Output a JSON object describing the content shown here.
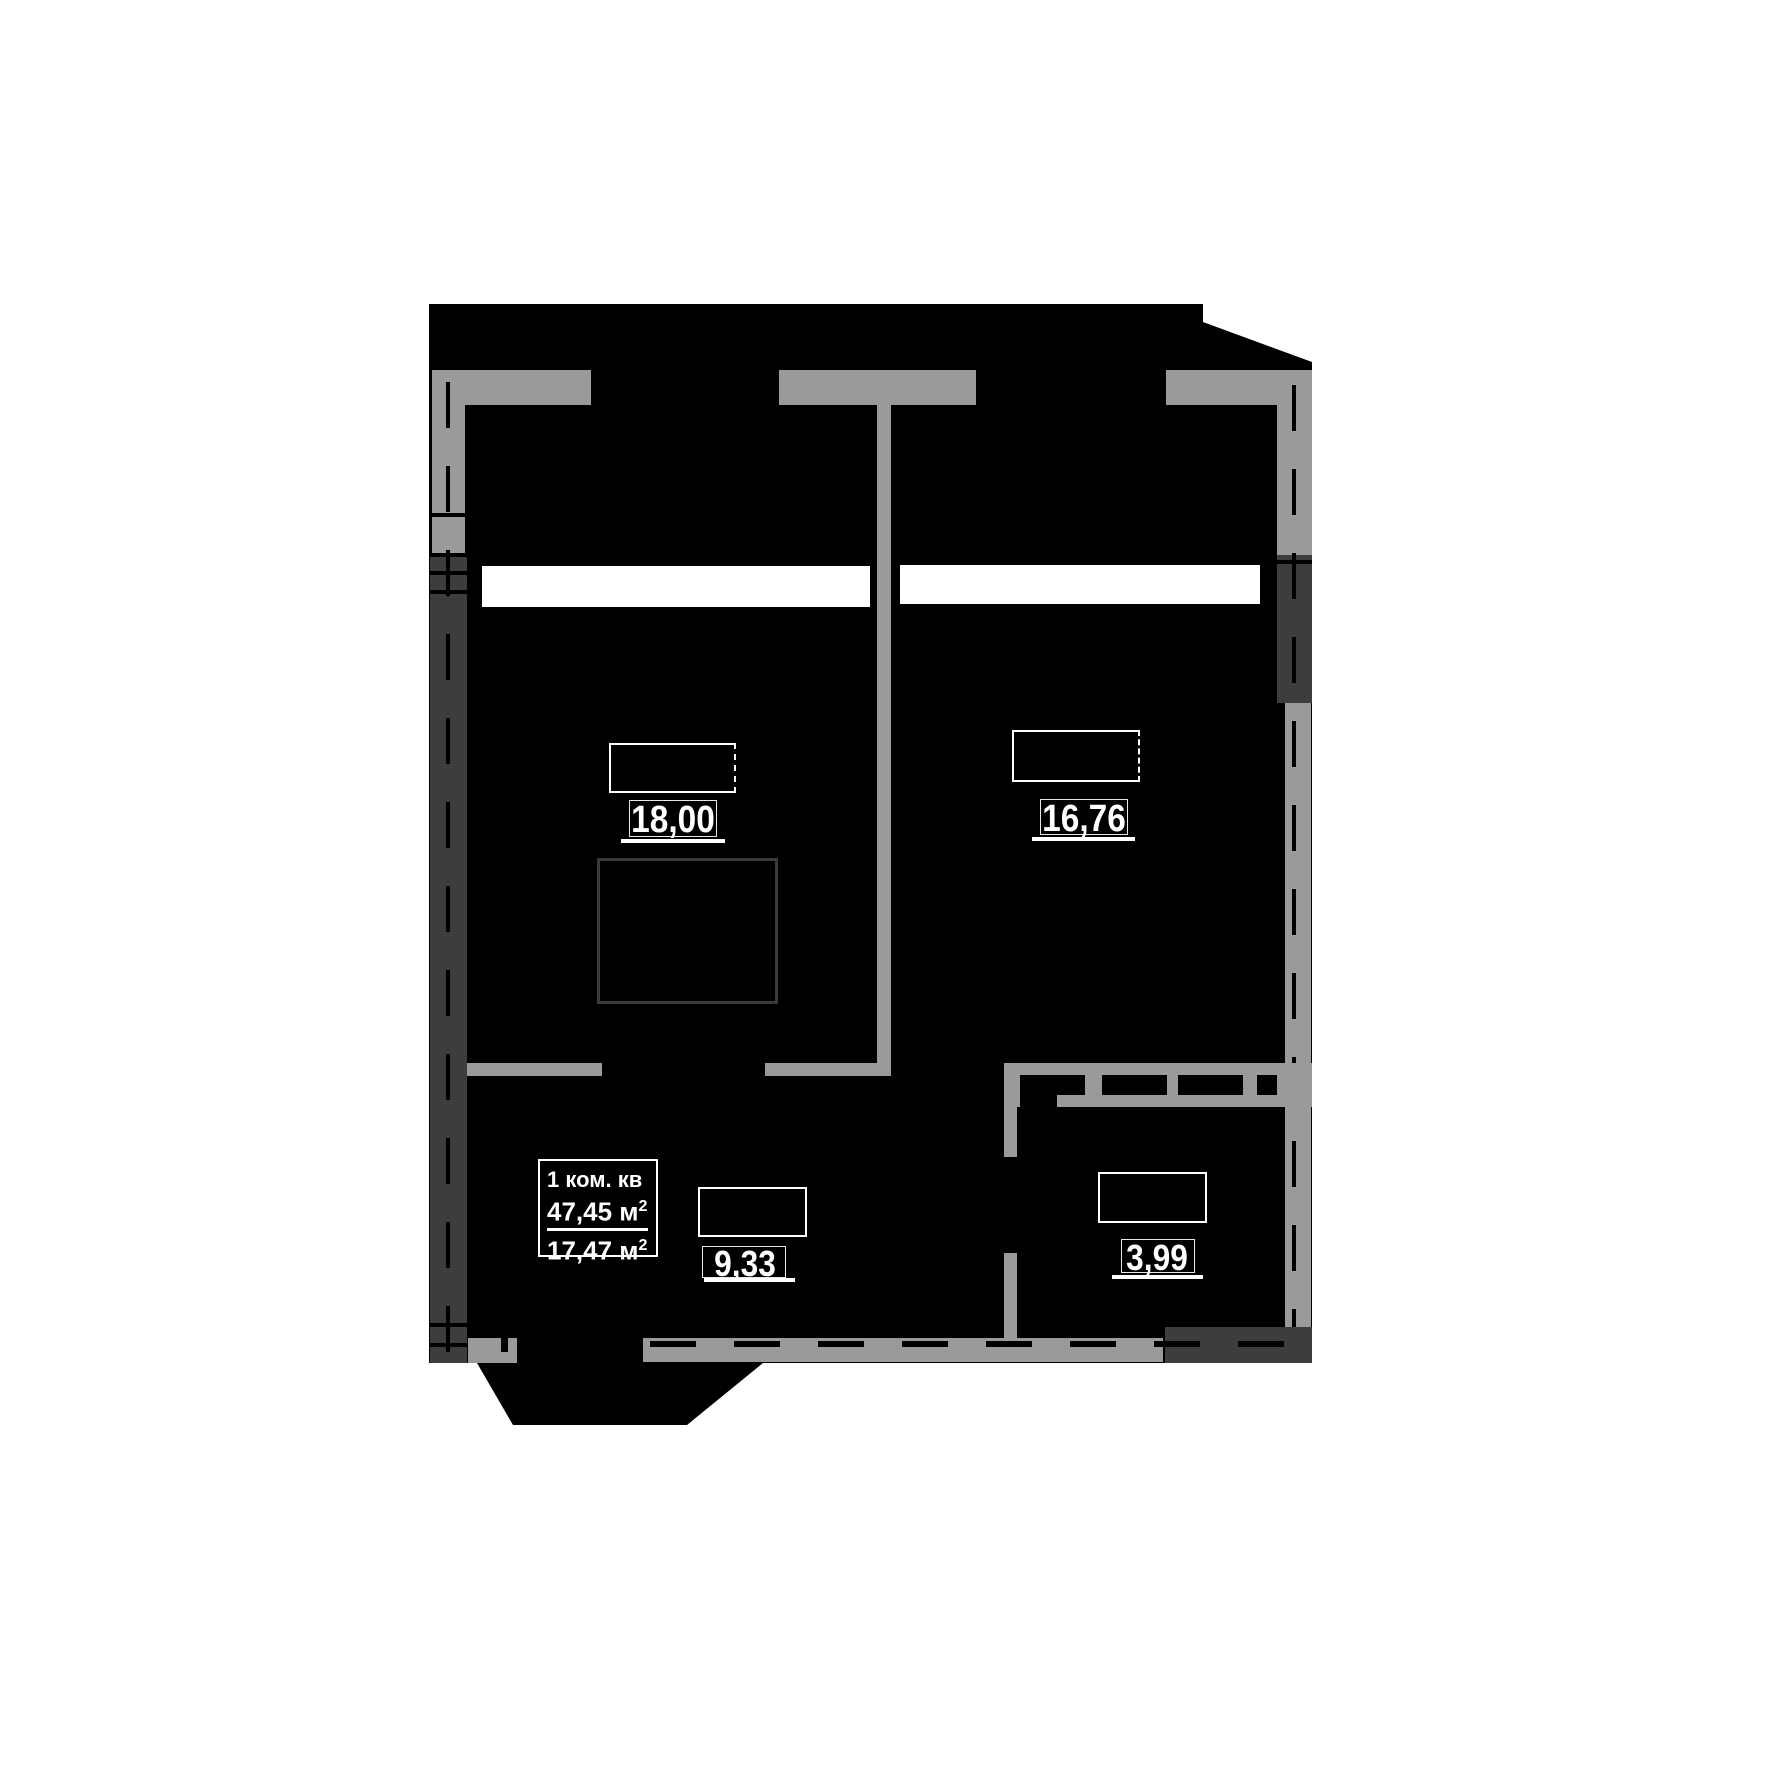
{
  "document": {
    "kind": "apartment floor plan",
    "language": "ru"
  },
  "colors": {
    "paper": "#ffffff",
    "plan_fill": "#000000",
    "wall_light": "#9a9a9a",
    "wall_dark": "#3d3d3d",
    "square_outline": "#3a3a3a",
    "text": "#ffffff"
  },
  "info_box": {
    "type_label": "1 ком. кв",
    "total_area_value": "47,45",
    "living_area_value": "17,47",
    "unit": " м",
    "unit_sup": "2"
  },
  "rooms": [
    {
      "id": "living-room",
      "area": "18,00"
    },
    {
      "id": "bedroom",
      "area": "16,76"
    },
    {
      "id": "hall",
      "area": "9,33"
    },
    {
      "id": "bathroom",
      "area": "3,99"
    }
  ]
}
